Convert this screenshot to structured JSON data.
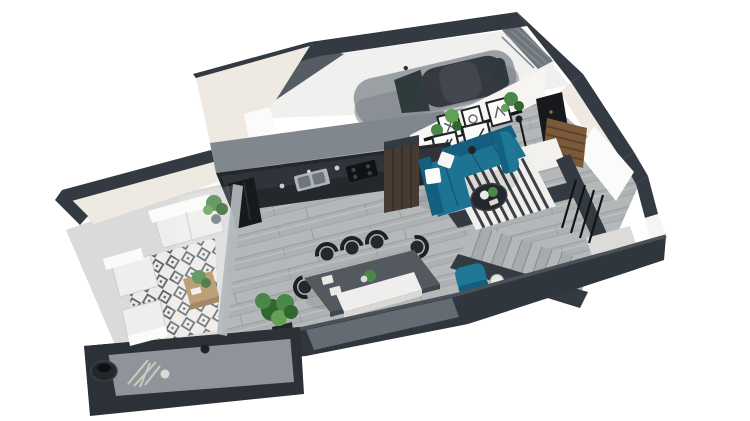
{
  "meta": {
    "title": "3D isometric cutaway floor-plan render of a modern apartment with garage",
    "view": "isometric cutaway, white background",
    "background": "#ffffff"
  },
  "colors": {
    "bg": "#ffffff",
    "wall": "#343a41",
    "wallTopLight": "#4a5158",
    "wallFaceCream": "#efeae1",
    "wallFaceWhite": "#f7f5f1",
    "innerWhite": "#fbfbfa",
    "graySlab": "#d8d6d2",
    "garageFloor": "#f0f0ee",
    "divWallTop": "#81878e",
    "innerWallShade": "#565c63",
    "floorWood": "#b5b8b9",
    "floorSeam": "#9b9ea0",
    "floorAlt": "#aeb1b3",
    "terraceConcrete": "#d9dad9",
    "tileBase": "#ecebe7",
    "tileMotif": "#596069",
    "ledgeDark": "#2c3137",
    "ledgeShelf": "#8e9499",
    "southWall": "#30363d",
    "kitchenCab": "#24282c",
    "counterTop": "#30343a",
    "applianceBlack": "#101214",
    "fridge": "#17191c",
    "steel": "#aeb4b9",
    "steelDark": "#6e757c",
    "woodPanel": "#463c33",
    "woodPanelLine": "#352e27",
    "sofaTeal": "#1d7392",
    "sofaTealDark": "#155e7d",
    "tealChair": "#1d7795",
    "rugWhite": "#f0efec",
    "rugStripe": "#3b4147",
    "tableDark": "#54595f",
    "chairBlack": "#24282d",
    "benchWhite": "#efeeec",
    "whiteSoft": "#f6f6f4",
    "frameBlack": "#1e2124",
    "shelfBlack": "#15181b",
    "plantGreen": "#4a8748",
    "plantGreenDark": "#31662f",
    "plantGreenLight": "#62a155",
    "potDark": "#23272c",
    "doorBrown": "#7a5a3b",
    "wardrobe": "#17191d",
    "stairTread": "#b4b7b9",
    "stairTreadAlt": "#a8abad",
    "landing": "#dcdbd8",
    "landingUpper": "#f2f1ee",
    "railBlack": "#101315",
    "glassFrame": "#b3b8bc",
    "carBody": "#9aa0a4",
    "carRoof": "#343a40",
    "carGlass": "#2e3a3c",
    "woodTable": "#b28e5e",
    "woodTableDark": "#93714a"
  },
  "rooms": [
    {
      "id": "garage",
      "label": "Garage",
      "contents": [
        "silver car with dark roof",
        "slatted side wall"
      ]
    },
    {
      "id": "kitchen",
      "label": "Kitchen",
      "contents": [
        "black cabinet run",
        "steel sink",
        "black hob",
        "black fridge",
        "dark wood accent panel"
      ]
    },
    {
      "id": "living-room",
      "label": "Living room",
      "contents": [
        "teal corner sofa with white pillows",
        "striped black-white rug",
        "round dark coffee table",
        "picture-ledge shelf with frames and hanging plants",
        "two leaning framed posters",
        "teal side chair",
        "floor lamp"
      ]
    },
    {
      "id": "dining-area",
      "label": "Dining area",
      "contents": [
        "dark rectangular table",
        "black spindle-back chairs",
        "white bench",
        "large potted plant",
        "place settings"
      ]
    },
    {
      "id": "entry-hall",
      "label": "Entry hall",
      "contents": [
        "brown slatted front door",
        "black wardrobe"
      ]
    },
    {
      "id": "staircase",
      "label": "Staircase",
      "contents": [
        "gray wood treads",
        "charcoal parapet walls",
        "black steel balusters",
        "upper and lower landings",
        "teal armchair with side table"
      ]
    },
    {
      "id": "terrace",
      "label": "Terrace",
      "contents": [
        "geometric tile rug",
        "white outdoor loveseat and two chairs",
        "wooden coffee table with plant",
        "potted plants",
        "dark decorative vase on ledge",
        "glass partition"
      ]
    }
  ]
}
